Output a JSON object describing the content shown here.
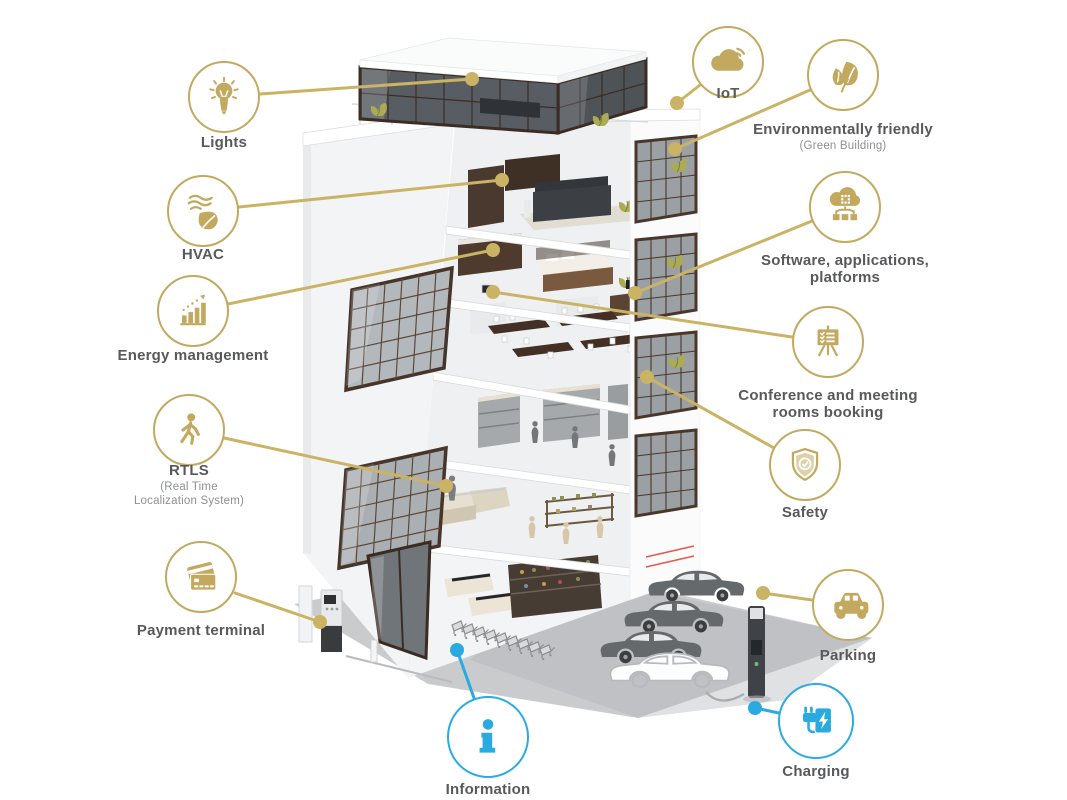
{
  "colors": {
    "accent_gold": "#C3A95F",
    "accent_blue": "#29ABE2",
    "label_text": "#58595B",
    "sublabel_text": "#8D8F92"
  },
  "features": [
    {
      "id": "lights",
      "label": "Lights",
      "icon": "lightbulb-icon"
    },
    {
      "id": "hvac",
      "label": "HVAC",
      "icon": "leaf-wind-icon"
    },
    {
      "id": "energy",
      "label": "Energy management",
      "icon": "bar-chart-icon"
    },
    {
      "id": "rtls",
      "label": "RTLS",
      "sublabel": "(Real Time Localization System)",
      "icon": "walking-person-icon"
    },
    {
      "id": "payment",
      "label": "Payment terminal",
      "icon": "credit-cards-icon"
    },
    {
      "id": "information",
      "label": "Information",
      "icon": "info-icon"
    },
    {
      "id": "iot",
      "label": "IoT",
      "icon": "cloud-wifi-icon"
    },
    {
      "id": "environment",
      "label": "Environmentally friendly",
      "sublabel": "(Green Building)",
      "icon": "leaves-icon"
    },
    {
      "id": "software",
      "label": "Software, applications, platforms",
      "icon": "cloud-network-icon"
    },
    {
      "id": "conference",
      "label": "Conference and meeting rooms booking",
      "icon": "presentation-board-icon"
    },
    {
      "id": "safety",
      "label": "Safety",
      "icon": "shield-check-icon"
    },
    {
      "id": "parking",
      "label": "Parking",
      "icon": "car-icon"
    },
    {
      "id": "charging",
      "label": "Charging",
      "icon": "ev-plug-icon"
    }
  ]
}
